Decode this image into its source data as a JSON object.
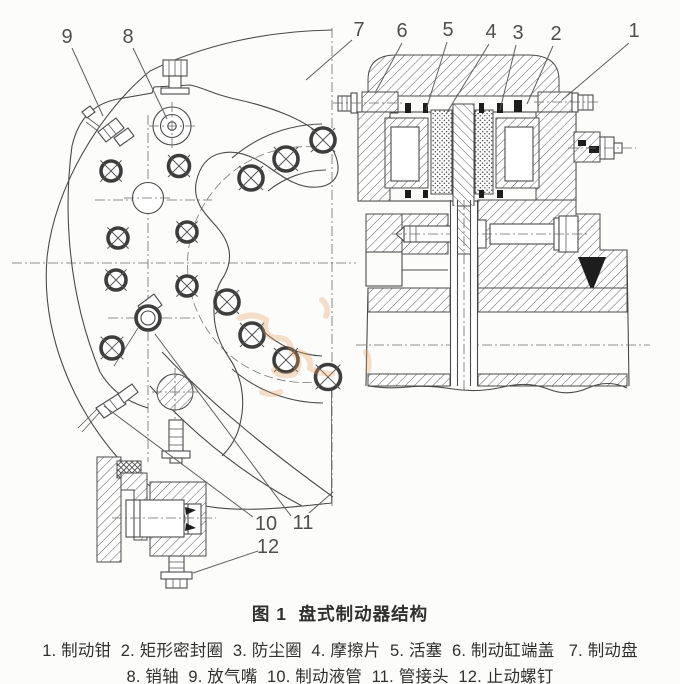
{
  "figure_caption": "图 1  盘式制动器结构",
  "legend": {
    "line1": "1. 制动钳  2. 矩形密封圈  3. 防尘圈  4. 摩擦片  5. 活塞  6. 制动缸端盖   7. 制动盘",
    "line2": "8. 销轴  9. 放气嘴  10. 制动液管  11. 管接头  12. 止动螺钉"
  },
  "parts": [
    {
      "num": "1",
      "name": "制动钳"
    },
    {
      "num": "2",
      "name": "矩形密封圈"
    },
    {
      "num": "3",
      "name": "防尘圈"
    },
    {
      "num": "4",
      "name": "摩擦片"
    },
    {
      "num": "5",
      "name": "活塞"
    },
    {
      "num": "6",
      "name": "制动缸端盖"
    },
    {
      "num": "7",
      "name": "制动盘"
    },
    {
      "num": "8",
      "name": "销轴"
    },
    {
      "num": "9",
      "name": "放气嘴"
    },
    {
      "num": "10",
      "name": "制动液管"
    },
    {
      "num": "11",
      "name": "管接头"
    },
    {
      "num": "12",
      "name": "止动螺钉"
    }
  ],
  "callouts": [
    {
      "label": "9"
    },
    {
      "label": "8"
    },
    {
      "label": "7"
    },
    {
      "label": "6"
    },
    {
      "label": "5"
    },
    {
      "label": "4"
    },
    {
      "label": "3"
    },
    {
      "label": "2"
    },
    {
      "label": "1"
    },
    {
      "label": "10"
    },
    {
      "label": "11"
    },
    {
      "label": "12"
    }
  ],
  "colors": {
    "line": "#4a4a4a",
    "text": "#303030",
    "callout_text": "#4f4f4f",
    "watermark": "#e8a265",
    "background": "#fcfcfa"
  }
}
